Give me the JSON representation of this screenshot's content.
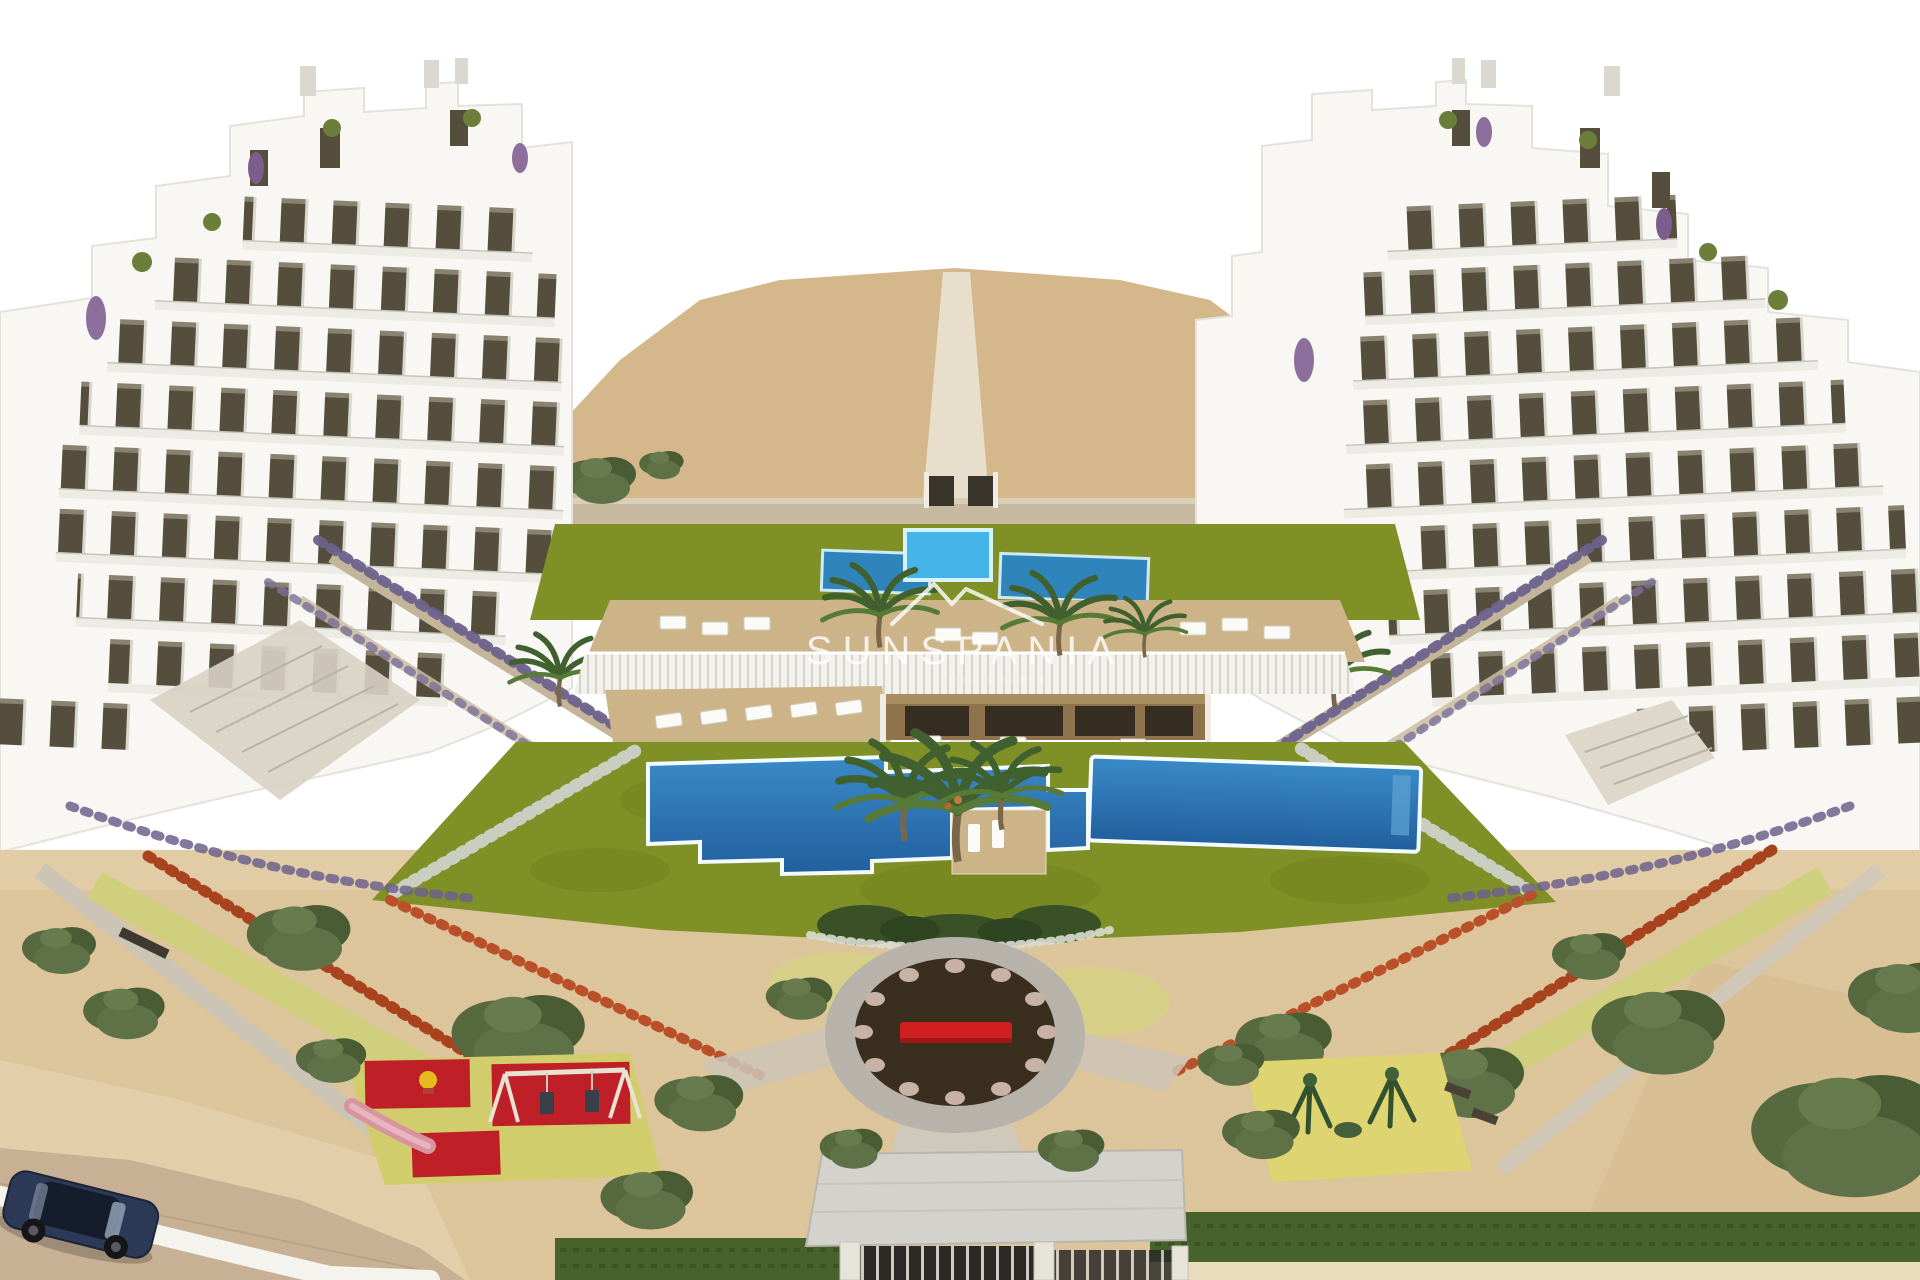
{
  "watermark": {
    "brand": "SUNSPANIA",
    "tagline": "real estate",
    "logo": "mountain-roofline-icon"
  },
  "palette": {
    "sky": "#ffffff",
    "sand_hill": "#d4b78a",
    "sand_ground": "#dcc49b",
    "lawn": "#7f9026",
    "pool_bright": "#45b4e8",
    "pool_lap": "#2f85bb",
    "pool_deep": "#2e77b5",
    "pool_rim": "#eefaff",
    "deck_wood": "#cdb488",
    "building_white": "#f8f7f3",
    "window_glass": "#554e3d",
    "pergola_wood": "#8f734c",
    "red_flowers": "#a8421f",
    "lavender": "#6d628c",
    "olive_green": "#57693f",
    "plaza_ring": "#b7b3aa",
    "plaza_soil": "#3a2e1f",
    "bench_red": "#d01f1f",
    "playground_red": "#bf1f26",
    "playground_base": "#d2cd6c",
    "play_area_yellow": "#ded472",
    "hedge_green": "#47632c",
    "canopy_gray": "#d3d2cc",
    "car_navy": "#2c3a57",
    "watermark_white": "#ffffff"
  }
}
